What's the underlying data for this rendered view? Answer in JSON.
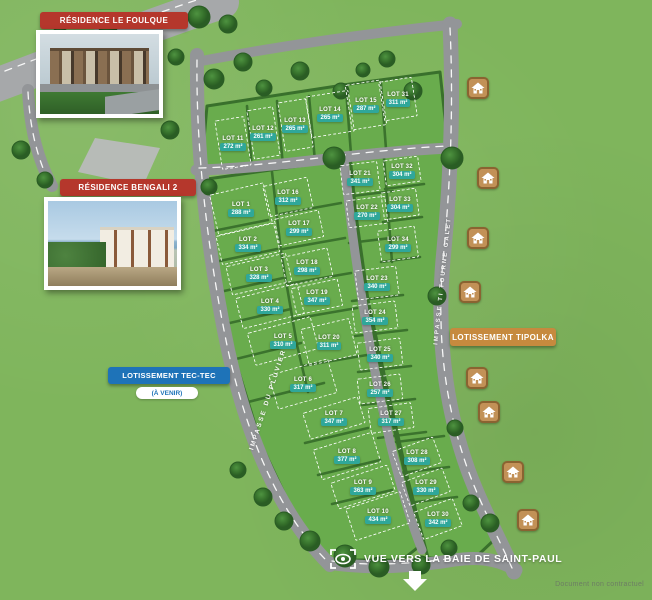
{
  "colors": {
    "grass": "#7fb55c",
    "block": "#69ac4d",
    "hedge": "#39702c",
    "road": "#939598",
    "road_light": "#a6a8aa",
    "teal": "#2fa79a",
    "red": "#b5372c",
    "blue": "#1e73b8",
    "orange": "#c68a3e",
    "icon_bg": "#c29157",
    "icon_border": "#8a6331"
  },
  "banners": {
    "residence1": "RÉSIDENCE LE FOULQUE",
    "residence2": "RÉSIDENCE BENGALI 2",
    "tectec": "LOTISSEMENT TEC-TEC",
    "tectec_sub": "(À VENIR)",
    "tipolka": "LOTISSEMENT TIPOLKA"
  },
  "streets": {
    "left": "IMPASSE DU PLUVIER",
    "right": "IMPASSE TI TOURNE GALET"
  },
  "footer": {
    "view": "VUE VERS LA BAIE DE SAINT-PAUL",
    "disclaimer": "Document non contractuel"
  },
  "lots": [
    {
      "n": "LOT 1",
      "a": "288 m²",
      "x": 241,
      "y": 209,
      "w": 56,
      "h": 42,
      "r": -13
    },
    {
      "n": "LOT 2",
      "a": "334 m²",
      "x": 248,
      "y": 244,
      "w": 60,
      "h": 30,
      "r": -13
    },
    {
      "n": "LOT 3",
      "a": "328 m²",
      "x": 259,
      "y": 274,
      "w": 62,
      "h": 30,
      "r": -13
    },
    {
      "n": "LOT 4",
      "a": "330 m²",
      "x": 270,
      "y": 306,
      "w": 64,
      "h": 32,
      "r": -14
    },
    {
      "n": "LOT 5",
      "a": "310 m²",
      "x": 283,
      "y": 341,
      "w": 66,
      "h": 34,
      "r": -15
    },
    {
      "n": "LOT 6",
      "a": "317 m²",
      "x": 303,
      "y": 384,
      "w": 62,
      "h": 36,
      "r": -16
    },
    {
      "n": "LOT 7",
      "a": "347 m²",
      "x": 334,
      "y": 418,
      "w": 58,
      "h": 28,
      "r": -17
    },
    {
      "n": "LOT 8",
      "a": "377 m²",
      "x": 347,
      "y": 456,
      "w": 62,
      "h": 32,
      "r": -17
    },
    {
      "n": "LOT 9",
      "a": "363 m²",
      "x": 363,
      "y": 487,
      "w": 60,
      "h": 28,
      "r": -18
    },
    {
      "n": "LOT 10",
      "a": "434 m²",
      "x": 378,
      "y": 516,
      "w": 58,
      "h": 34,
      "r": -18
    },
    {
      "n": "LOT 11",
      "a": "272 m²",
      "x": 233,
      "y": 143,
      "w": 30,
      "h": 50,
      "r": -9
    },
    {
      "n": "LOT 12",
      "a": "261 m²",
      "x": 263,
      "y": 133,
      "w": 27,
      "h": 50,
      "r": -9
    },
    {
      "n": "LOT 13",
      "a": "265 m²",
      "x": 295,
      "y": 125,
      "w": 29,
      "h": 50,
      "r": -9
    },
    {
      "n": "LOT 14",
      "a": "265 m²",
      "x": 330,
      "y": 114,
      "w": 44,
      "h": 42,
      "r": -9
    },
    {
      "n": "LOT 15",
      "a": "287 m²",
      "x": 366,
      "y": 105,
      "w": 36,
      "h": 46,
      "r": -9
    },
    {
      "n": "LOT 16",
      "a": "312 m²",
      "x": 288,
      "y": 197,
      "w": 46,
      "h": 32,
      "r": -12
    },
    {
      "n": "LOT 17",
      "a": "299 m²",
      "x": 299,
      "y": 228,
      "w": 46,
      "h": 28,
      "r": -12
    },
    {
      "n": "LOT 18",
      "a": "298 m²",
      "x": 307,
      "y": 267,
      "w": 48,
      "h": 30,
      "r": -12
    },
    {
      "n": "LOT 19",
      "a": "347 m²",
      "x": 317,
      "y": 297,
      "w": 48,
      "h": 28,
      "r": -12
    },
    {
      "n": "LOT 20",
      "a": "311 m²",
      "x": 329,
      "y": 342,
      "w": 50,
      "h": 38,
      "r": -13
    },
    {
      "n": "LOT 21",
      "a": "341 m²",
      "x": 360,
      "y": 178,
      "w": 38,
      "h": 30,
      "r": -7
    },
    {
      "n": "LOT 22",
      "a": "270 m²",
      "x": 367,
      "y": 212,
      "w": 40,
      "h": 28,
      "r": -7
    },
    {
      "n": "LOT 23",
      "a": "340 m²",
      "x": 377,
      "y": 283,
      "w": 42,
      "h": 30,
      "r": -7
    },
    {
      "n": "LOT 24",
      "a": "354 m²",
      "x": 375,
      "y": 317,
      "w": 44,
      "h": 28,
      "r": -7
    },
    {
      "n": "LOT 25",
      "a": "340 m²",
      "x": 380,
      "y": 354,
      "w": 44,
      "h": 28,
      "r": -7
    },
    {
      "n": "LOT 26",
      "a": "257 m²",
      "x": 380,
      "y": 389,
      "w": 44,
      "h": 26,
      "r": -7
    },
    {
      "n": "LOT 27",
      "a": "317 m²",
      "x": 391,
      "y": 418,
      "w": 44,
      "h": 26,
      "r": -8
    },
    {
      "n": "LOT 28",
      "a": "308 m²",
      "x": 417,
      "y": 457,
      "w": 44,
      "h": 28,
      "r": -20
    },
    {
      "n": "LOT 29",
      "a": "330 m²",
      "x": 426,
      "y": 487,
      "w": 44,
      "h": 26,
      "r": -20
    },
    {
      "n": "LOT 30",
      "a": "342 m²",
      "x": 438,
      "y": 519,
      "w": 42,
      "h": 30,
      "r": -20
    },
    {
      "n": "LOT 31",
      "a": "311 m²",
      "x": 398,
      "y": 99,
      "w": 34,
      "h": 40,
      "r": -9
    },
    {
      "n": "LOT 32",
      "a": "304 m²",
      "x": 402,
      "y": 171,
      "w": 36,
      "h": 26,
      "r": -8
    },
    {
      "n": "LOT 33",
      "a": "304 m²",
      "x": 400,
      "y": 204,
      "w": 36,
      "h": 28,
      "r": -8
    },
    {
      "n": "LOT 34",
      "a": "299 m²",
      "x": 398,
      "y": 244,
      "w": 38,
      "h": 32,
      "r": -8
    }
  ],
  "house_icons": [
    {
      "x": 478,
      "y": 88
    },
    {
      "x": 488,
      "y": 178
    },
    {
      "x": 478,
      "y": 238
    },
    {
      "x": 470,
      "y": 292
    },
    {
      "x": 477,
      "y": 378
    },
    {
      "x": 489,
      "y": 412
    },
    {
      "x": 513,
      "y": 472
    },
    {
      "x": 528,
      "y": 520
    }
  ]
}
